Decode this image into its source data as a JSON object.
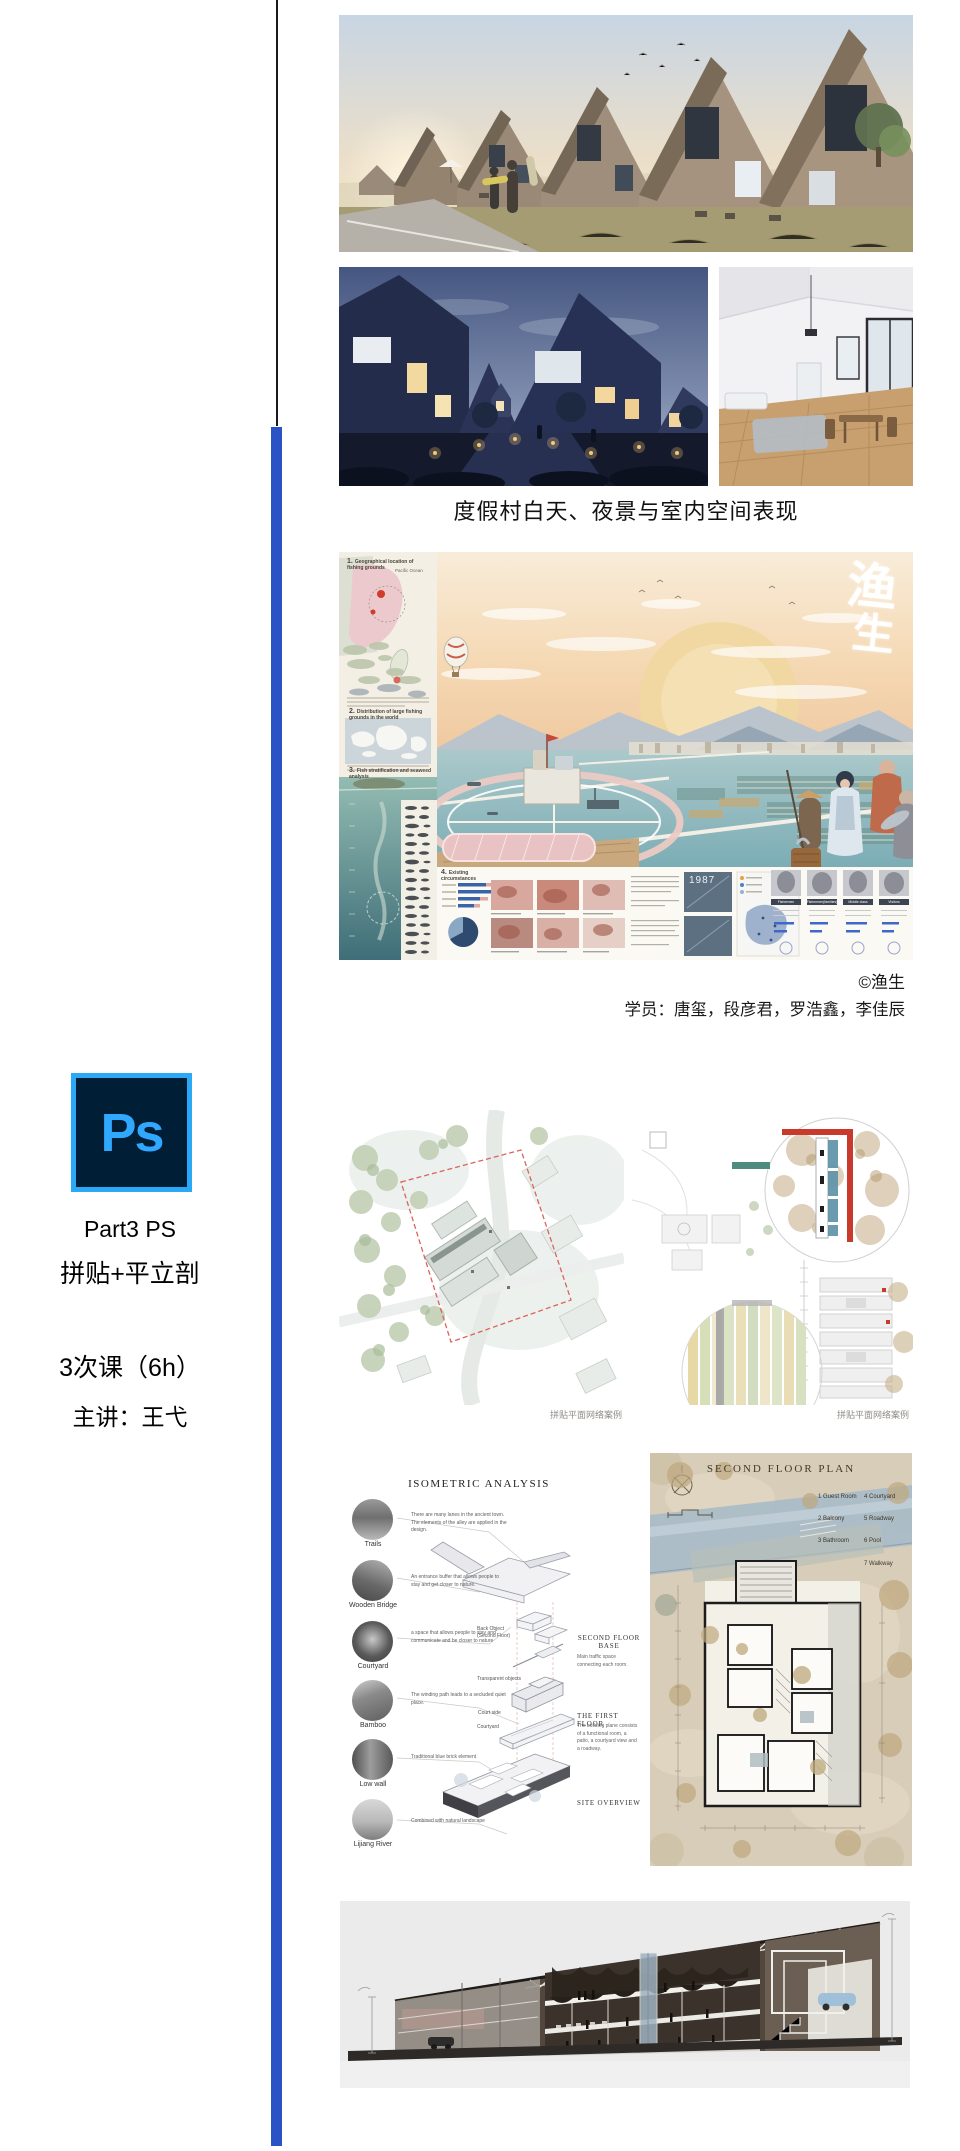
{
  "page": {
    "background": "#ffffff"
  },
  "dividers": {
    "black": "#1b1b1b",
    "blue": "#2a54c6"
  },
  "sidebar": {
    "logo_text": "Ps",
    "line1": "Part3 PS",
    "line2": "拼贴+平立剖",
    "line3": "3次课（6h）",
    "line4": "主讲：王弋",
    "logo_bg": "#001e36",
    "logo_accent": "#31a8ff"
  },
  "gallery": {
    "caption": "度假村白天、夜景与室内空间表现",
    "images": [
      "resort-day-render",
      "resort-night-render",
      "resort-interior-render"
    ]
  },
  "poster": {
    "watermark_char1": "渔",
    "watermark_char2": "生",
    "pacific_label": "Pacific Ocean",
    "section1_num": "1.",
    "section1_title": "Geographical location of fishing grounds",
    "section2_num": "2.",
    "section2_title": "Distribution of large fishing grounds in the world",
    "section3_num": "3.",
    "section3_title": "Fish stratification and seaweed analysis",
    "section4_num": "4.",
    "section4_title": "Existing circumstances",
    "year_label": "1987",
    "col_headers": [
      "Fishermen",
      "Fishermen(families)",
      "Middle class",
      "Visitors"
    ]
  },
  "credits": {
    "copyright": "©渔生",
    "students": "学员：唐玺，段彦君，罗浩鑫，李佳辰"
  },
  "plans": {
    "caption_left": "拼贴平面网络案例",
    "caption_right": "拼贴平面网络案例"
  },
  "isometric": {
    "title": "ISOMETRIC ANALYSIS",
    "items": [
      {
        "label": "Trails",
        "note": "There are many lanes in the ancient town. The elements of the alley are applied in the design."
      },
      {
        "label": "Wooden Bridge",
        "note": "An entrance buffer that allows people to stay and get closer to nature."
      },
      {
        "label": "Courtyard",
        "note": "a space that allows people to stay and communicate and be closer to nature"
      },
      {
        "label": "Bamboo",
        "note": "The winding path leads to a secluded quiet place."
      },
      {
        "label": "Low wall",
        "note": "Traditional blue brick element"
      },
      {
        "label": "Lijiang River",
        "note": "Combined with natural landscape"
      }
    ],
    "mid_labels": [
      "Back Object (Second Floor)",
      "Transparent objects",
      "Court side",
      "Courtyard"
    ],
    "stages": [
      {
        "title": "SECOND FLOOR BASE",
        "note": "Main traffic space connecting each room."
      },
      {
        "title": "THE FIRST FLOOR",
        "note": "The building plane consists of a functional room, a patio, a courtyard view and a roadway."
      },
      {
        "title": "SITE OVERVIEW",
        "note": ""
      }
    ]
  },
  "floor_plan": {
    "title": "SECOND FLOOR PLAN",
    "legend_left": [
      "1 Guest Room",
      "2 Balcony",
      "3 Bathroom"
    ],
    "legend_right": [
      "4 Courtyard",
      "5 Roadway",
      "6 Pool",
      "7 Walkway"
    ]
  }
}
